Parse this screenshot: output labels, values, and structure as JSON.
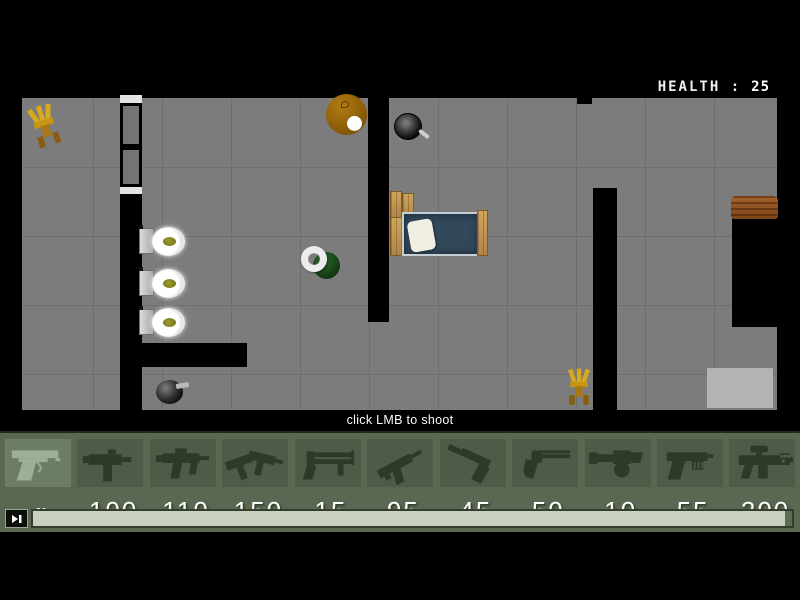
{
  "hud": {
    "health_label": "HEALTH :",
    "health_value": "25"
  },
  "hint_text": "click LMB to shoot",
  "weapon_bar": {
    "slots": [
      {
        "id": "desert-eagle",
        "ammo": "∞",
        "selected": true
      },
      {
        "id": "mac-10",
        "ammo": "100"
      },
      {
        "id": "mp5",
        "ammo": "110"
      },
      {
        "id": "dual-uzis",
        "ammo": "150"
      },
      {
        "id": "sawed-off-shotgun",
        "ammo": "15"
      },
      {
        "id": "machine-pistol",
        "ammo": "95"
      },
      {
        "id": "silenced-pistol",
        "ammo": "45"
      },
      {
        "id": "revolver",
        "ammo": "50"
      },
      {
        "id": "grenade-launcher",
        "ammo": "10"
      },
      {
        "id": "auto-pistol",
        "ammo": "55"
      },
      {
        "id": "scoped-rifle",
        "ammo": "200"
      }
    ]
  },
  "map": {
    "objects": [
      "chair",
      "window-wall",
      "toilet",
      "toilet",
      "toilet",
      "round-table",
      "frying-pan",
      "bed",
      "player",
      "gun-pickup",
      "chair",
      "wooden-desk",
      "rug"
    ]
  },
  "colors": {
    "background": "#000000",
    "floor": "#7c7c7c",
    "grid_line": "#6e6e6e",
    "wall": "#000000",
    "bar_bg": "#5a6851",
    "slot_bg": "#4d5b47",
    "slot_selected_bg": "#6d7c64",
    "ammo_text": "#ffffff",
    "health_text": "#ffffff",
    "wood": "#c79d55",
    "bed_mattress": "#31475a",
    "chair": "#d8a81e",
    "scroll_track_fill": "#c8d0bf"
  }
}
